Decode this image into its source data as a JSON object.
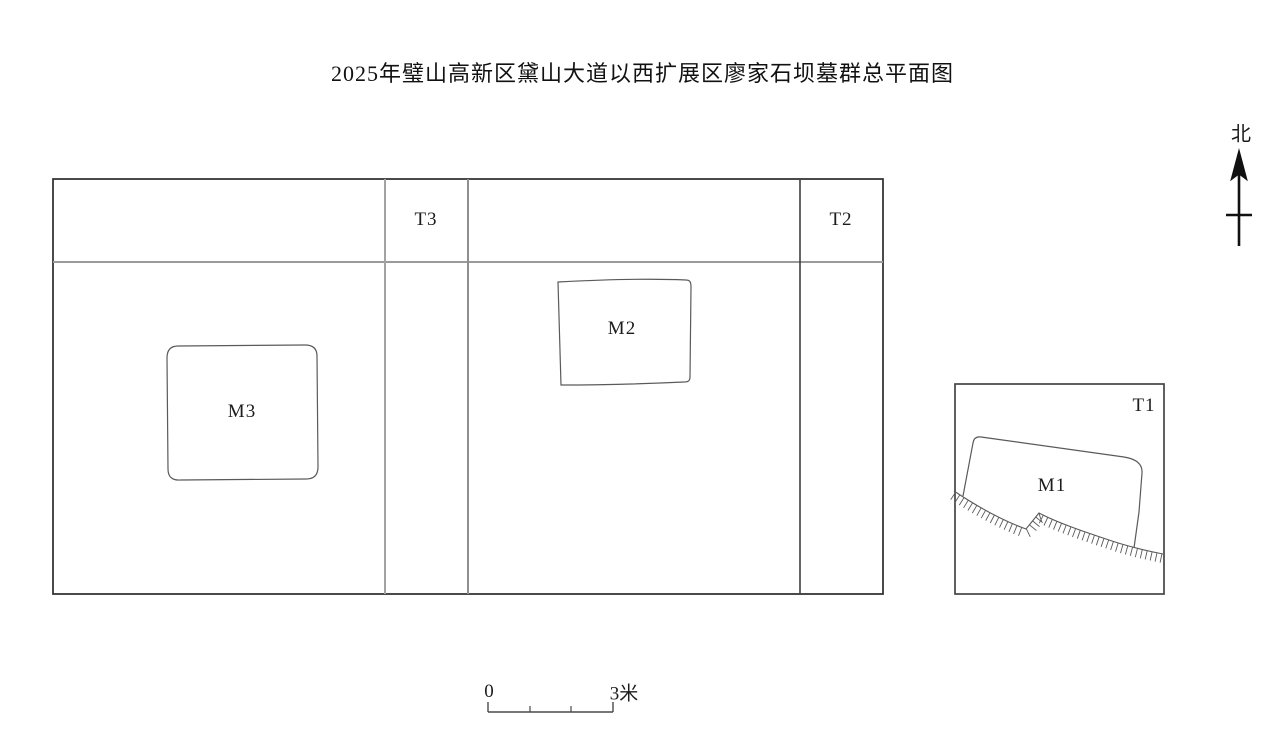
{
  "title": "2025年璧山高新区黛山大道以西扩展区廖家石坝墓群总平面图",
  "compass": {
    "north_label": "北"
  },
  "plan": {
    "trenches": [
      {
        "label": "T1"
      },
      {
        "label": "T2"
      },
      {
        "label": "T3"
      }
    ],
    "tombs": [
      {
        "label": "M1"
      },
      {
        "label": "M2"
      },
      {
        "label": "M3"
      }
    ]
  },
  "scale_bar": {
    "zero_label": "0",
    "length_label": "3米"
  },
  "colors": {
    "background": "#ffffff",
    "ink": "#1c1c1c",
    "outline_dark": "#2b2b2b",
    "grid_gray": "#9a9a9a",
    "feature_line": "#5a5a5a"
  }
}
